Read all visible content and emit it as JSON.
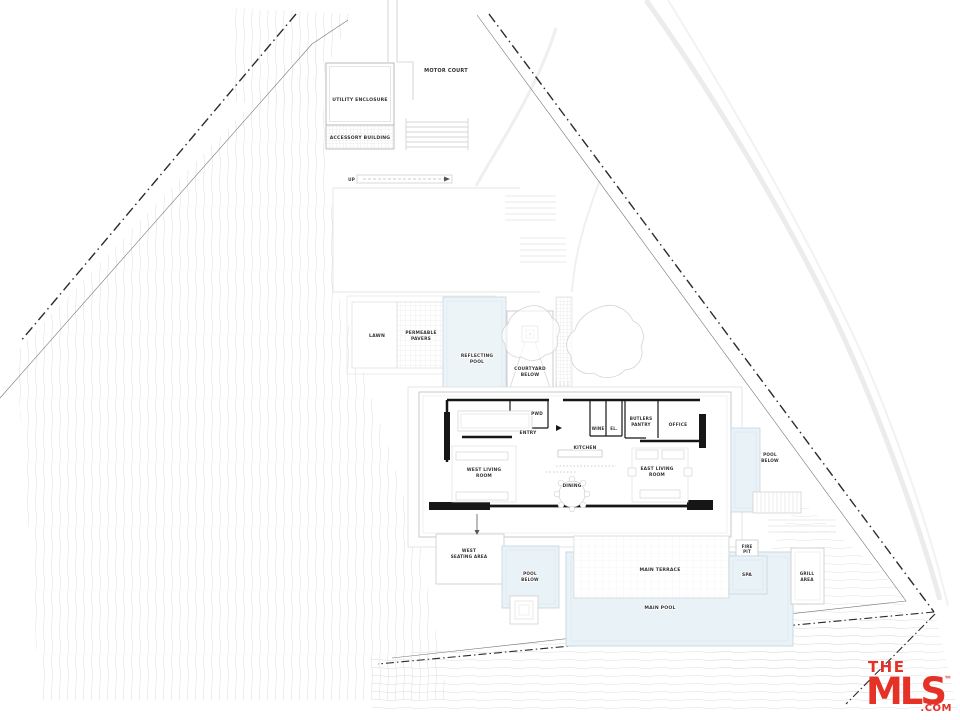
{
  "plan": {
    "site": {
      "motor_court": "MOTOR COURT",
      "utility_enclosure": "UTILITY ENCLOSURE",
      "accessory_building": "ACCESSORY BUILDING",
      "up": "UP",
      "lawn": "LAWN",
      "permeable_pavers": [
        "PERMEABLE",
        "PAVERS"
      ],
      "reflecting_pool": [
        "REFLECTING",
        "POOL"
      ],
      "courtyard_below": [
        "COURTYARD",
        "BELOW"
      ]
    },
    "house": {
      "pwd": "PWD",
      "entry": "ENTRY",
      "wine": "WINE",
      "el": "EL.",
      "butlers_pantry": [
        "BUTLERS",
        "PANTRY"
      ],
      "office": "OFFICE",
      "kitchen": "KITCHEN",
      "west_living_room": [
        "WEST LIVING",
        "ROOM"
      ],
      "dining": "DINING",
      "east_living_room": [
        "EAST LIVING",
        "ROOM"
      ]
    },
    "outdoor": {
      "pool_below_east": [
        "POOL",
        "BELOW"
      ],
      "west_seating_area": [
        "WEST",
        "SEATING AREA"
      ],
      "pool_below_west": [
        "POOL",
        "BELOW"
      ],
      "main_terrace": "MAIN TERRACE",
      "fire_pit": [
        "FIRE",
        "PIT"
      ],
      "spa": "SPA",
      "grill_area": [
        "GRILL",
        "AREA"
      ],
      "main_pool": "MAIN POOL"
    }
  },
  "watermark": {
    "the": "THE",
    "mls": "MLS",
    "tm": "™",
    "com": ".COM"
  },
  "colors": {
    "background": "#ffffff",
    "pool_fill": "#e9f2f7",
    "pool_edge": "#c6d6e0",
    "wall": "#161616",
    "outline_light": "#c9c9c9",
    "contour": "#e7e7e7",
    "boundary": "#2a2a2a",
    "label_text": "#333333",
    "logo_red": "#e53126"
  }
}
